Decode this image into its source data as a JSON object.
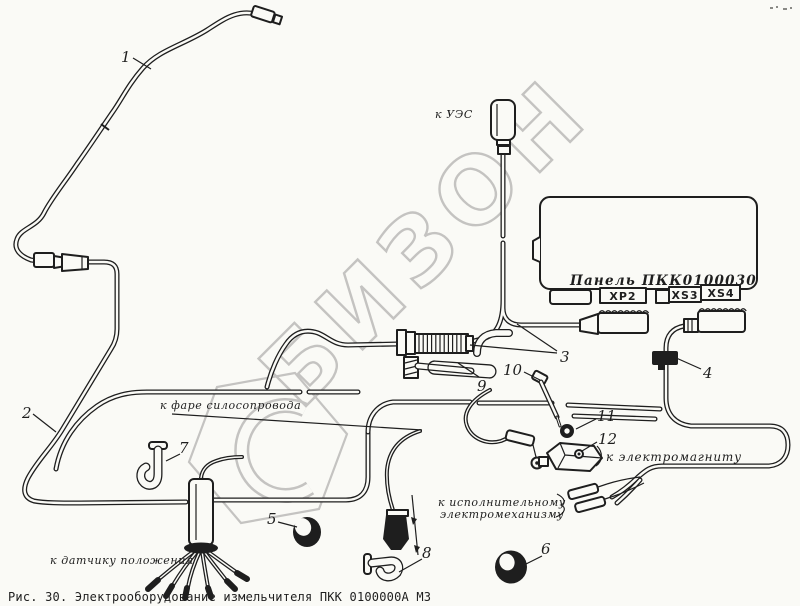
{
  "colors": {
    "paper": "#fafaf6",
    "ink": "#1e1e1e",
    "wm": "#c2c1bf"
  },
  "watermark": {
    "text": "БИЗОН"
  },
  "panel": {
    "label": "Панель ПКК0100030",
    "connectors": [
      "ХР2",
      "XS3",
      "XS4"
    ]
  },
  "labels": {
    "ues": "к УЭС",
    "silage_light": "к фаре силосопровода",
    "electromagnet": "к электромагниту",
    "actuator_l1": "к исполнительному",
    "actuator_l2": "электромеханизму",
    "position_sensor": "к датчику положения"
  },
  "callouts": {
    "c1": "1",
    "c2": "2",
    "c3": "3",
    "c4": "4",
    "c5": "5",
    "c6": "6",
    "c7": "7",
    "c8": "8",
    "c9": "9",
    "c10": "10",
    "c11": "11",
    "c12": "12"
  },
  "caption": "Рис. 30. Электрооборудование измельчителя ПКК 0100000А МЗ"
}
